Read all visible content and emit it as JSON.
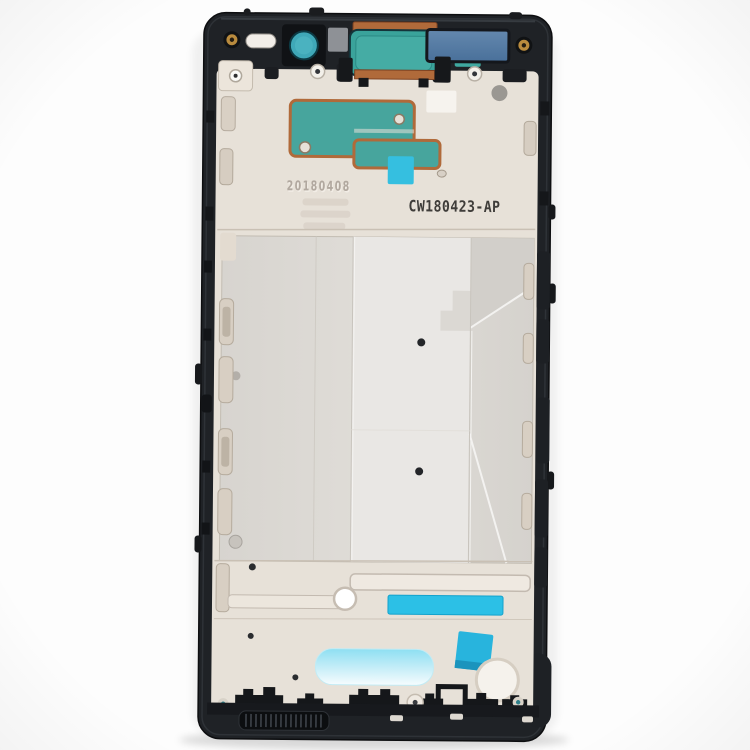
{
  "meta": {
    "description": "Product photograph: smartphone middle-frame bezel plate (front housing chassis spare part) centered on a white background"
  },
  "part": {
    "markings": {
      "etched_date": "20180408",
      "printed_code": "CW180423-AP"
    },
    "colors": {
      "background": "#fdfdfd",
      "frame_black": "#1f2226",
      "plate_beige": "#e7e1d8",
      "midplate_silver": "#dbd8d3",
      "adhesive_teal": "#47a59d",
      "copper_trace": "#b06a3a",
      "cyan_bright": "#2cc0e6",
      "cyan_light": "#8edff2",
      "insert_blue": "#5b80a8",
      "screw_gold": "#b98b3e",
      "camera_ring_teal": "#3fa8b8"
    }
  }
}
